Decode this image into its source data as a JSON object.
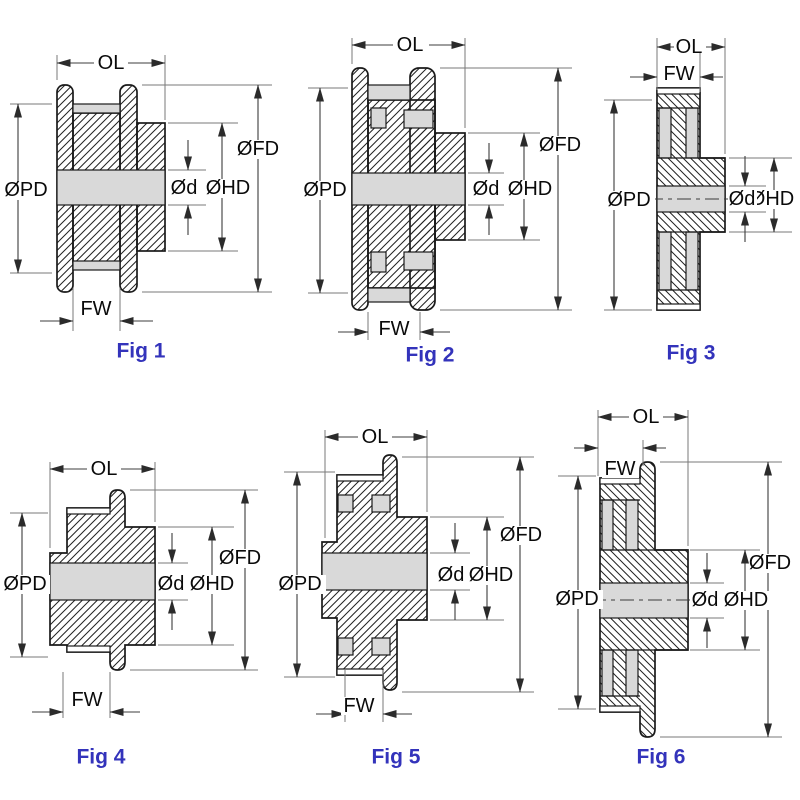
{
  "colors": {
    "background": "#ffffff",
    "outline": "#1a1a1a",
    "metal_fill": "#d9d9d9",
    "caption": "#3333bb"
  },
  "figures": [
    {
      "caption": "Fig 1",
      "labels": {
        "ol": "OL",
        "fw": "FW",
        "pd": "ØPD",
        "fd": "ØFD",
        "hd": "ØHD",
        "d": "Ød"
      }
    },
    {
      "caption": "Fig 2",
      "labels": {
        "ol": "OL",
        "fw": "FW",
        "pd": "ØPD",
        "fd": "ØFD",
        "hd": "ØHD",
        "d": "Ød"
      }
    },
    {
      "caption": "Fig 3",
      "labels": {
        "ol": "OL",
        "fw": "FW",
        "pd": "ØPD",
        "hd": "ØHD",
        "d": "Ød"
      }
    },
    {
      "caption": "Fig 4",
      "labels": {
        "ol": "OL",
        "fw": "FW",
        "pd": "ØPD",
        "fd": "ØFD",
        "hd": "ØHD",
        "d": "Ød"
      }
    },
    {
      "caption": "Fig 5",
      "labels": {
        "ol": "OL",
        "fw": "FW",
        "pd": "ØPD",
        "fd": "ØFD",
        "hd": "ØHD",
        "d": "Ød"
      }
    },
    {
      "caption": "Fig 6",
      "labels": {
        "ol": "OL",
        "fw": "FW",
        "pd": "ØPD",
        "fd": "ØFD",
        "hd": "ØHD",
        "d": "Ød"
      }
    }
  ]
}
